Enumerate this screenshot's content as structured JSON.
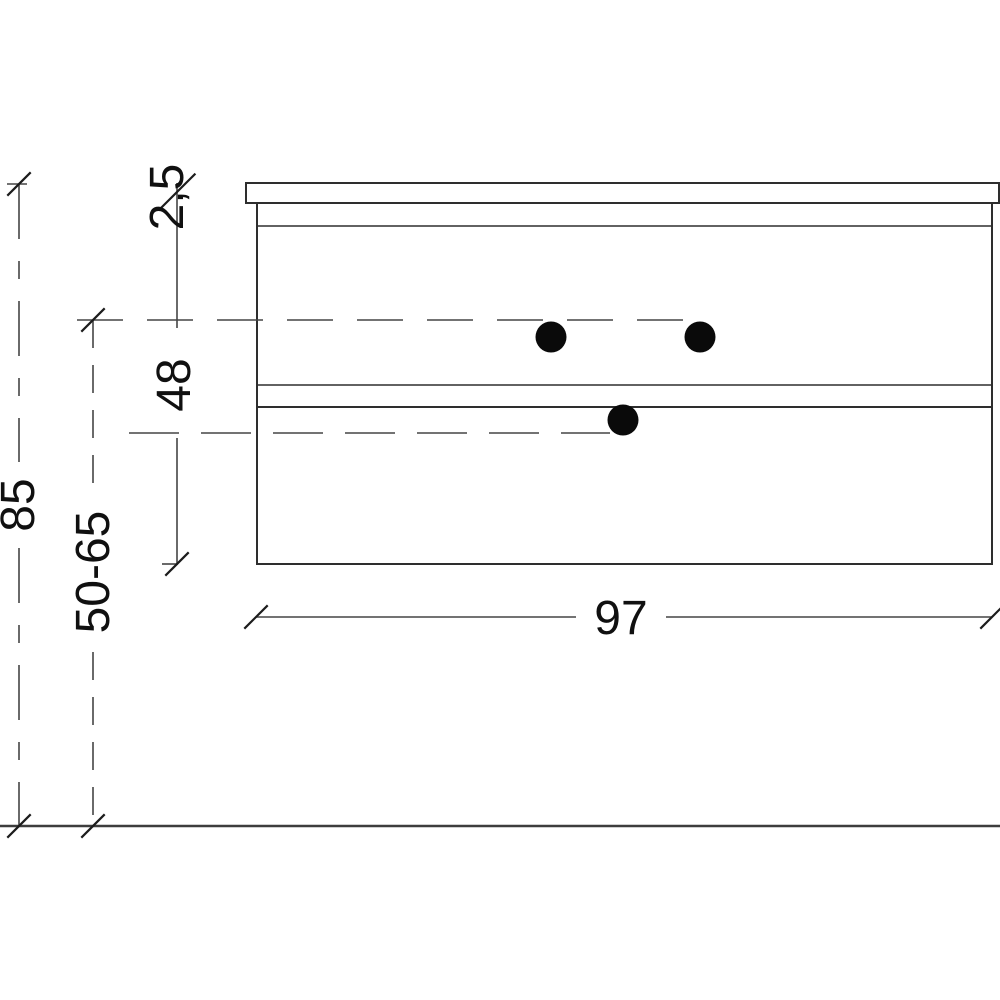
{
  "drawing": {
    "type": "furniture-dimension-drawing",
    "view": "side-elevation-vanity-cabinet",
    "dimensions": {
      "countertop_thickness": "2,5",
      "cabinet_height": "48",
      "total_height": "85",
      "mounting_height_range": "50-65",
      "width": "97"
    },
    "colors": {
      "background": "#ffffff",
      "outline": "#2e2e2e",
      "dimension_line": "#454545",
      "tick": "#1c1c1c",
      "text": "#101010",
      "hole_dot": "#0a0a0a"
    }
  }
}
